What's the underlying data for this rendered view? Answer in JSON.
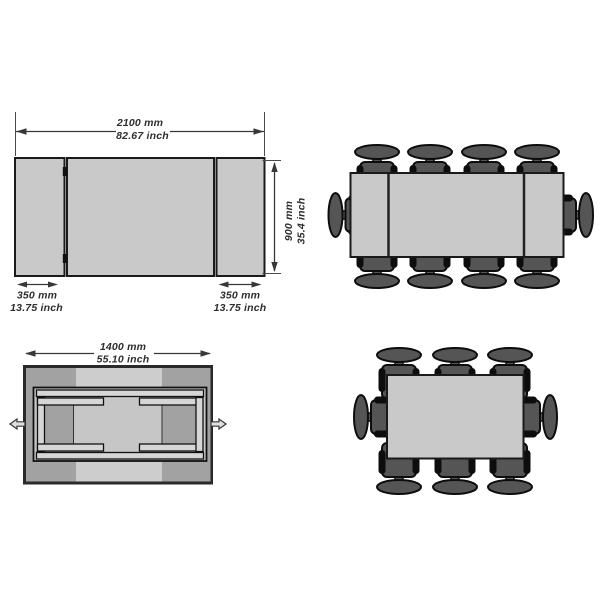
{
  "page": {
    "background": "#ffffff"
  },
  "colors": {
    "tabletop": "#c9c9c9",
    "table_outline": "#1a1a1a",
    "chair_fill": "#555555",
    "chair_outline": "#0d0d0d",
    "dimension_text": "#2d2d2d",
    "mechanism_dark": "#a2a2a2",
    "mechanism_light": "#cdcdcd",
    "rail_fill": "#d6d6d6"
  },
  "labels": {
    "extended_width_mm": "2100 mm",
    "extended_width_inch": "82.67 inch",
    "depth_mm": "900 mm",
    "depth_inch": "35.4 inch",
    "left_leaf_mm": "350 mm",
    "left_leaf_inch": "13.75 inch",
    "right_leaf_mm": "350 mm",
    "right_leaf_inch": "13.75 inch",
    "folded_width_mm": "1400 mm",
    "folded_width_inch": "55.10 inch"
  },
  "seating": {
    "extended_view_chairs": 10,
    "compact_view_chairs": 8
  }
}
